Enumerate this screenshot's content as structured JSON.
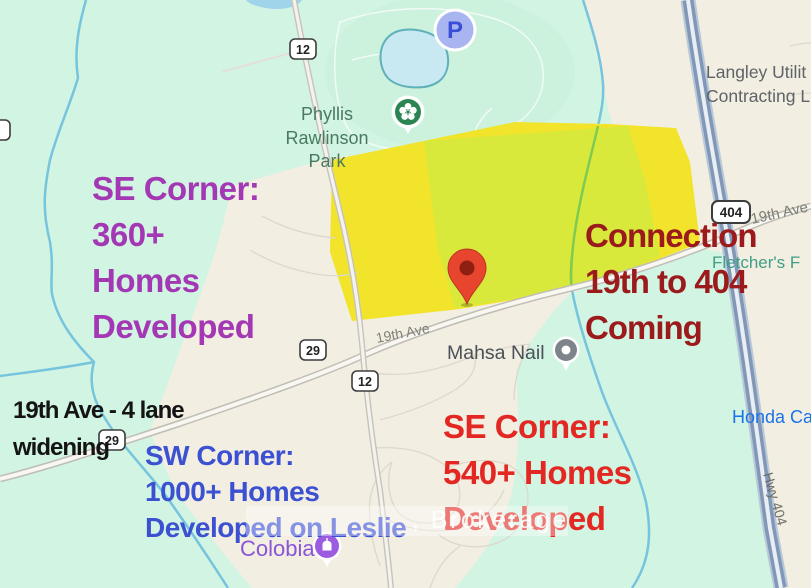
{
  "map": {
    "park_label": {
      "line1": "Phyllis",
      "line2": "Rawlinson",
      "line3": "Park"
    },
    "pois": {
      "langley_line1": "Langley Utilit",
      "langley_line2": "Contracting L",
      "fletchers": "Fletcher's F",
      "honda": "Honda Ca",
      "mahsa": "Mahsa Nail",
      "colobia": "Colobia",
      "parking_letter": "P"
    },
    "road_shields": {
      "top_12": "12",
      "mid_29": "29",
      "mid_12": "12",
      "left_29": "29",
      "hwy_404": "404"
    },
    "road_labels": {
      "nineteenth_mid": "19th Ave",
      "nineteenth_right": "19th Ave",
      "hwy404": "Hwy 404"
    },
    "colors": {
      "mint_green": "#d2f4e2",
      "beige": "#f2eee2",
      "parcel_yellow": "#f1e42a",
      "parcel_yellow_green": "#d8e93c",
      "highway_blue": "#8098b6",
      "creek_blue": "#76c4de",
      "pin_red": "#e8452e",
      "poi_purple": "#9b5ce0",
      "annotation_purple": "#a438b4",
      "annotation_darkred": "#9b1a1c",
      "annotation_blue": "#3c50d2",
      "annotation_red": "#e32722",
      "annotation_black": "#141414",
      "honda_blue": "#1a73e8",
      "fletchers_green": "#3f9e85",
      "park_label_green": "#497a60"
    }
  },
  "annotations": {
    "se360": {
      "lines": [
        "SE Corner:",
        "360+",
        "Homes",
        "Developed"
      ]
    },
    "connection": {
      "lines": [
        "Connection",
        "19th to 404",
        "Coming"
      ]
    },
    "widening": {
      "lines": [
        "19th Ave - 4 lane",
        "widening"
      ]
    },
    "sw1000": {
      "lines": [
        "SW Corner:",
        "1000+ Homes",
        "Developed on Leslie"
      ]
    },
    "se540": {
      "lines": [
        "SE Corner:",
        "540+ Homes",
        "Developed"
      ]
    }
  },
  "watermark": {
    "visible_text": ", Brokerage"
  }
}
